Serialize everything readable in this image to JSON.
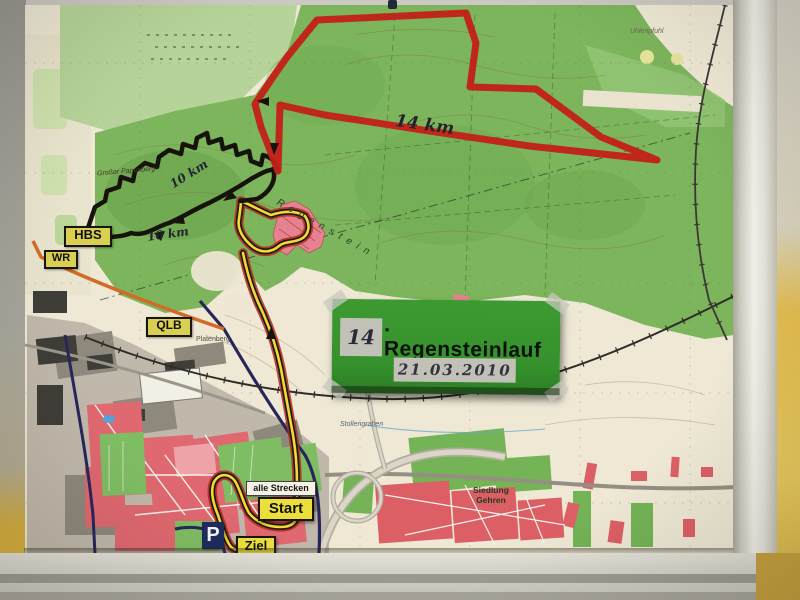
{
  "scene": {
    "description": "Photograph of a topographic running-course map taped to a wall above a white sill"
  },
  "event_sign": {
    "edition": "14",
    "title_rest": ". Regensteinlauf",
    "date": "21.03.2010"
  },
  "road_signs": {
    "hbs": "HBS",
    "wr": "WR",
    "qlb": "QLB"
  },
  "course": {
    "all_courses": "alle Strecken",
    "start": "Start",
    "finish": "Ziel",
    "parking": "P"
  },
  "annotations": {
    "red_distance": "14 km",
    "black_distance_upper": "10 km",
    "black_distance_lower": "10 km"
  },
  "places": {
    "papenberg": "Großer Papenberg",
    "regenstein": "Regenstein",
    "platenberg": "Platenberg",
    "stollengraben": "Stollengraben",
    "siedlung_line1": "Siedlung",
    "siedlung_line2": "Gehren",
    "uhlenpfuhl": "Uhlenpfuhl"
  },
  "colors": {
    "route_red": "#c42018",
    "route_black": "#15130b",
    "route_yellow": "#f2d838",
    "sign_green": "#35912c",
    "road_sign_yellow": "#d9d052",
    "wall_yellow": "#e3bd4f"
  }
}
